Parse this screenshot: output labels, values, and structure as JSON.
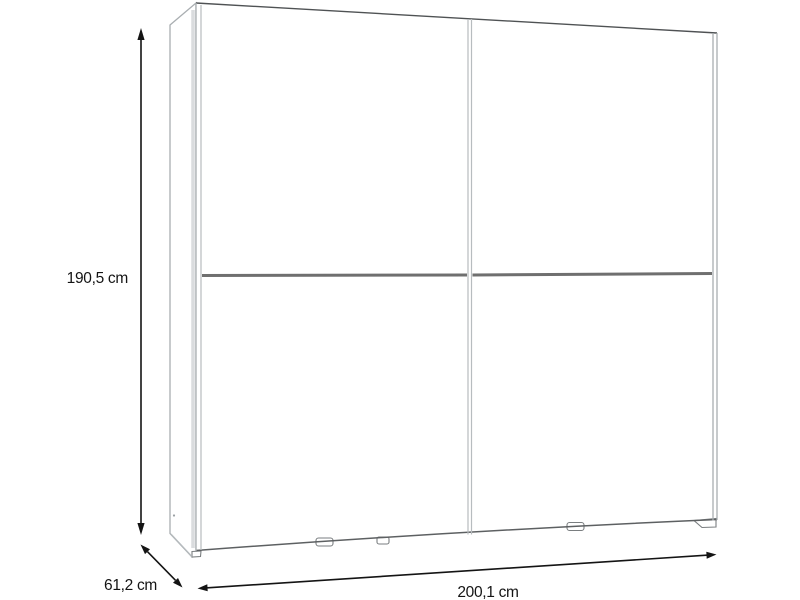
{
  "diagram": {
    "subject": "sliding-door wardrobe, three-quarter front view",
    "dimensions": {
      "height": {
        "label": "190,5 cm"
      },
      "depth": {
        "label": "61,2 cm"
      },
      "width": {
        "label": "200,1 cm"
      }
    },
    "colors": {
      "background": "#ffffff",
      "outline_light": "#a9aeb1",
      "outline_dark": "#4f5254",
      "seam": "#6f6f6f",
      "arrow": "#141414",
      "text": "#141414"
    }
  }
}
